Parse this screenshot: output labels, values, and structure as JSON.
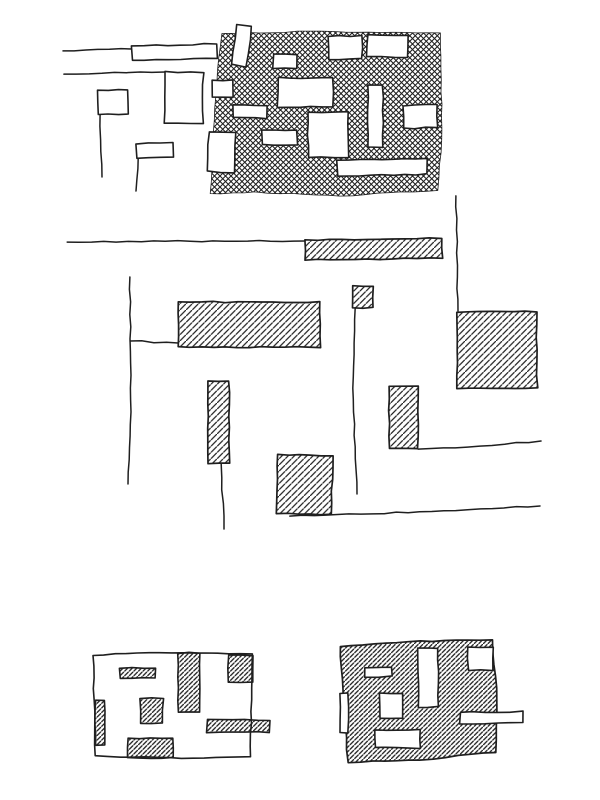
{
  "style": {
    "ink": "#1f1f1f",
    "paper": "#ffffff"
  },
  "sketch": {
    "top_left_outline_plan": {
      "lines": [
        {
          "name": "street-line",
          "points": [
            [
              63,
              51
            ],
            [
              132,
              49
            ]
          ]
        },
        {
          "name": "street-line",
          "points": [
            [
              64,
              74
            ],
            [
              165,
              72
            ]
          ]
        },
        {
          "name": "flag-pole-line",
          "points": [
            [
              100,
              114
            ],
            [
              102,
              177
            ]
          ]
        },
        {
          "name": "flag-pole-line",
          "points": [
            [
              138,
              158
            ],
            [
              136,
              191
            ]
          ]
        }
      ],
      "rects": [
        {
          "name": "outlined-bar",
          "x": 132,
          "y": 45,
          "w": 85,
          "h": 14,
          "tilt": -1.5
        },
        {
          "name": "outlined-block",
          "x": 165,
          "y": 72,
          "w": 38,
          "h": 51,
          "tilt": 0.5
        },
        {
          "name": "outlined-flag",
          "x": 98,
          "y": 90,
          "w": 30,
          "h": 24,
          "tilt": -1
        },
        {
          "name": "outlined-flag",
          "x": 136,
          "y": 143,
          "w": 37,
          "h": 15,
          "tilt": -3
        }
      ]
    },
    "top_figure_ground_block": {
      "region": [
        [
          222,
          34
        ],
        [
          310,
          31
        ],
        [
          440,
          33
        ],
        [
          442,
          128
        ],
        [
          438,
          190
        ],
        [
          340,
          196
        ],
        [
          255,
          192
        ],
        [
          210,
          194
        ],
        [
          214,
          120
        ],
        [
          219,
          58
        ]
      ],
      "buildings": [
        {
          "x": 234,
          "y": 25,
          "w": 15,
          "h": 41,
          "tilt": 8
        },
        {
          "x": 273,
          "y": 54,
          "w": 24,
          "h": 14,
          "tilt": 0
        },
        {
          "x": 328,
          "y": 36,
          "w": 34,
          "h": 23,
          "tilt": -1
        },
        {
          "x": 367,
          "y": 35,
          "w": 41,
          "h": 22,
          "tilt": 1.5
        },
        {
          "x": 212,
          "y": 80,
          "w": 21,
          "h": 17,
          "tilt": 0
        },
        {
          "x": 278,
          "y": 78,
          "w": 55,
          "h": 29,
          "tilt": 0.5
        },
        {
          "x": 368,
          "y": 85,
          "w": 15,
          "h": 62,
          "tilt": 0
        },
        {
          "x": 403,
          "y": 105,
          "w": 34,
          "h": 23,
          "tilt": -1
        },
        {
          "x": 233,
          "y": 105,
          "w": 34,
          "h": 13,
          "tilt": 0.5
        },
        {
          "x": 308,
          "y": 112,
          "w": 40,
          "h": 45,
          "tilt": 0
        },
        {
          "x": 208,
          "y": 132,
          "w": 27,
          "h": 40,
          "tilt": 2
        },
        {
          "x": 262,
          "y": 130,
          "w": 35,
          "h": 15,
          "tilt": 0
        },
        {
          "x": 337,
          "y": 159,
          "w": 90,
          "h": 16,
          "tilt": -1
        }
      ]
    },
    "middle_street_plan": {
      "lines": [
        {
          "name": "street-line",
          "points": [
            [
              67,
              242
            ],
            [
              190,
              241
            ],
            [
              305,
              241
            ]
          ]
        },
        {
          "name": "street-line",
          "points": [
            [
              456,
              196
            ],
            [
              458,
              311
            ]
          ]
        },
        {
          "name": "street-line",
          "points": [
            [
              130,
              277
            ],
            [
              131,
              400
            ],
            [
              128,
              484
            ]
          ]
        },
        {
          "name": "street-line",
          "points": [
            [
              130,
              341
            ],
            [
              178,
              343
            ]
          ]
        },
        {
          "name": "street-line",
          "points": [
            [
              355,
              308
            ],
            [
              353,
              400
            ],
            [
              357,
              494
            ]
          ]
        },
        {
          "name": "street-line",
          "points": [
            [
              221,
              464
            ],
            [
              224,
              529
            ]
          ]
        },
        {
          "name": "street-line",
          "points": [
            [
              290,
              516
            ],
            [
              420,
              512
            ],
            [
              540,
              506
            ]
          ]
        },
        {
          "name": "street-line",
          "points": [
            [
              418,
              449
            ],
            [
              480,
              446
            ],
            [
              541,
              441
            ]
          ]
        }
      ],
      "buildings": [
        {
          "x": 305,
          "y": 239,
          "w": 137,
          "h": 20,
          "tilt": -0.8
        },
        {
          "x": 457,
          "y": 312,
          "w": 80,
          "h": 76,
          "tilt": -0.5
        },
        {
          "x": 178,
          "y": 302,
          "w": 142,
          "h": 45,
          "tilt": 0
        },
        {
          "x": 353,
          "y": 286,
          "w": 20,
          "h": 22,
          "tilt": 0
        },
        {
          "x": 208,
          "y": 381,
          "w": 21,
          "h": 82,
          "tilt": 0
        },
        {
          "x": 277,
          "y": 455,
          "w": 55,
          "h": 59,
          "tilt": 1
        },
        {
          "x": 389,
          "y": 386,
          "w": 29,
          "h": 63,
          "tilt": 0
        }
      ]
    },
    "bottom_left_plan": {
      "outline": [
        [
          93,
          655
        ],
        [
          160,
          652
        ],
        [
          252,
          654
        ],
        [
          251,
          723
        ],
        [
          250,
          757
        ],
        [
          170,
          758
        ],
        [
          95,
          756
        ],
        [
          94,
          700
        ]
      ],
      "buildings": [
        {
          "x": 120,
          "y": 668,
          "w": 35,
          "h": 10,
          "tilt": 0
        },
        {
          "x": 178,
          "y": 653,
          "w": 22,
          "h": 59,
          "tilt": 0
        },
        {
          "x": 228,
          "y": 655,
          "w": 25,
          "h": 27,
          "tilt": 0
        },
        {
          "x": 140,
          "y": 698,
          "w": 23,
          "h": 25,
          "tilt": 0
        },
        {
          "x": 95,
          "y": 700,
          "w": 10,
          "h": 45,
          "tilt": 0
        },
        {
          "x": 128,
          "y": 738,
          "w": 45,
          "h": 20,
          "tilt": 0
        },
        {
          "x": 207,
          "y": 720,
          "w": 63,
          "h": 12,
          "tilt": 0
        }
      ]
    },
    "bottom_right_plan": {
      "region": [
        [
          340,
          646
        ],
        [
          420,
          641
        ],
        [
          492,
          640
        ],
        [
          497,
          700
        ],
        [
          496,
          752
        ],
        [
          420,
          760
        ],
        [
          348,
          762
        ],
        [
          343,
          700
        ]
      ],
      "buildings": [
        {
          "x": 365,
          "y": 667,
          "w": 27,
          "h": 10,
          "tilt": -2
        },
        {
          "x": 418,
          "y": 648,
          "w": 20,
          "h": 59,
          "tilt": 0
        },
        {
          "x": 468,
          "y": 647,
          "w": 25,
          "h": 23,
          "tilt": 0
        },
        {
          "x": 380,
          "y": 693,
          "w": 22,
          "h": 25,
          "tilt": 0
        },
        {
          "x": 340,
          "y": 693,
          "w": 8,
          "h": 40,
          "tilt": 0
        },
        {
          "x": 375,
          "y": 730,
          "w": 45,
          "h": 18,
          "tilt": 0
        },
        {
          "x": 460,
          "y": 712,
          "w": 63,
          "h": 11,
          "tilt": -1
        }
      ]
    }
  }
}
